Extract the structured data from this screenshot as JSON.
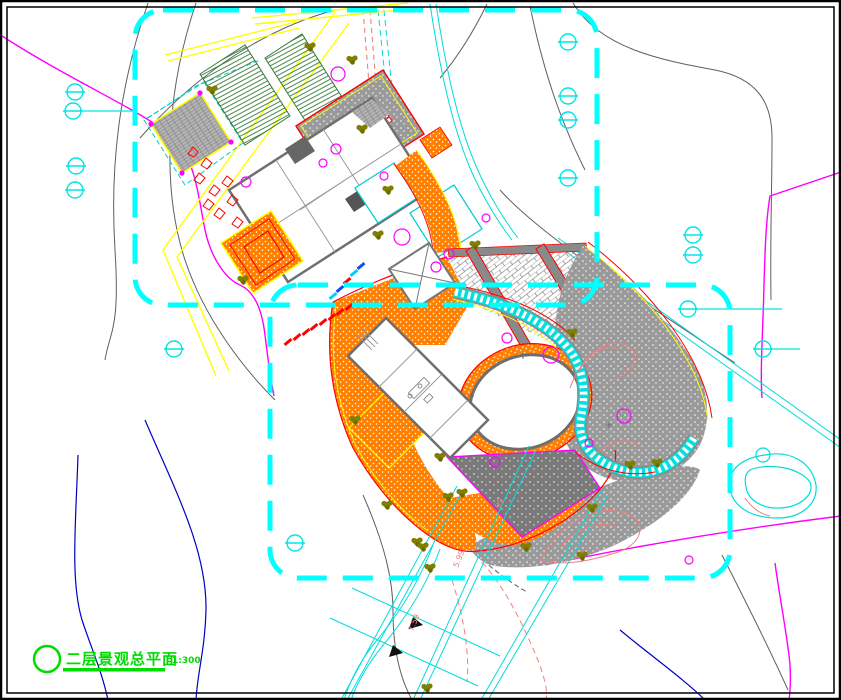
{
  "drawing": {
    "title_block": {
      "title": "二层景观总平面",
      "scale": "1:300"
    },
    "elevation_labels": [
      {
        "text": "7.99"
      },
      {
        "text": "5.99"
      },
      {
        "text": "7.59"
      }
    ],
    "palette": {
      "boundary_cyan": "#00FFFF",
      "road_yellow": "#FFFF00",
      "paving_orange": "#FF7F00",
      "edge_red": "#FF0000",
      "contour_gray": "#5F5F5F",
      "contour_blue": "#0000C8",
      "line_magenta": "#FF00FF",
      "contour_salmon": "#F08080",
      "tree_olive": "#7F7F00",
      "title_green": "#00DC00"
    },
    "symbols": {
      "survey_marker": "circle-with-crossbar",
      "tree_round": "olive-canopy-cluster",
      "shrub": "magenta-circle"
    }
  }
}
